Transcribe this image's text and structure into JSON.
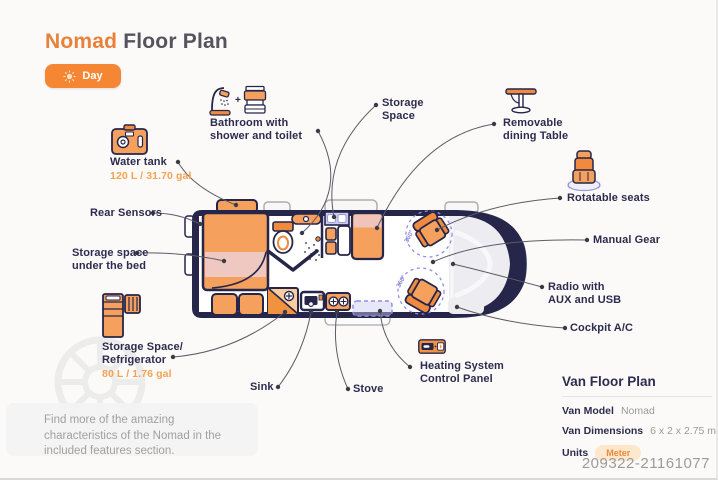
{
  "header": {
    "title_accent": "Nomad",
    "title_rest": " Floor Plan",
    "mode_toggle": {
      "label": "Day",
      "icon": "sun-icon"
    }
  },
  "callouts": {
    "bathroom": {
      "label": "Bathroom with shower and toilet"
    },
    "storage_space": {
      "label": "Storage Space"
    },
    "dining_table": {
      "label": "Removable dining Table"
    },
    "water_tank": {
      "label": "Water tank",
      "value": "120 L / 31.70 gal"
    },
    "rear_sensors": {
      "label": "Rear Sensors"
    },
    "under_bed": {
      "label": "Storage space under the bed"
    },
    "fridge": {
      "label": "Storage Space/ Refrigerator",
      "value": "80 L / 1.76 gal"
    },
    "sink": {
      "label": "Sink"
    },
    "stove": {
      "label": "Stove"
    },
    "heating": {
      "label": "Heating System Control Panel"
    },
    "rotatable_seats": {
      "label": "Rotatable seats"
    },
    "manual_gear": {
      "label": "Manual Gear"
    },
    "radio": {
      "label": "Radio with AUX and USB"
    },
    "cockpit_ac": {
      "label": "Cockpit A/C"
    }
  },
  "floorplan": {
    "seat_rotation": "360°"
  },
  "info_panel": {
    "title": "Van Floor Plan",
    "rows": [
      {
        "label": "Van Model",
        "value": "Nomad"
      },
      {
        "label": "Van Dimensions",
        "value": "6 x 2 x 2.75 m"
      },
      {
        "label": "Units",
        "value": "Meter"
      }
    ]
  },
  "footer_note": "Find more of the amazing characteristics of the Nomad in the included features section.",
  "watermark_id": "209322-21161077",
  "colors": {
    "accent_orange": "#f58634",
    "furniture_orange": "#f5a05c",
    "navy_outline": "#26254a",
    "lavender": "#cbcaf2",
    "pink": "#efc8c2",
    "label_navy": "#2d2c4e"
  }
}
